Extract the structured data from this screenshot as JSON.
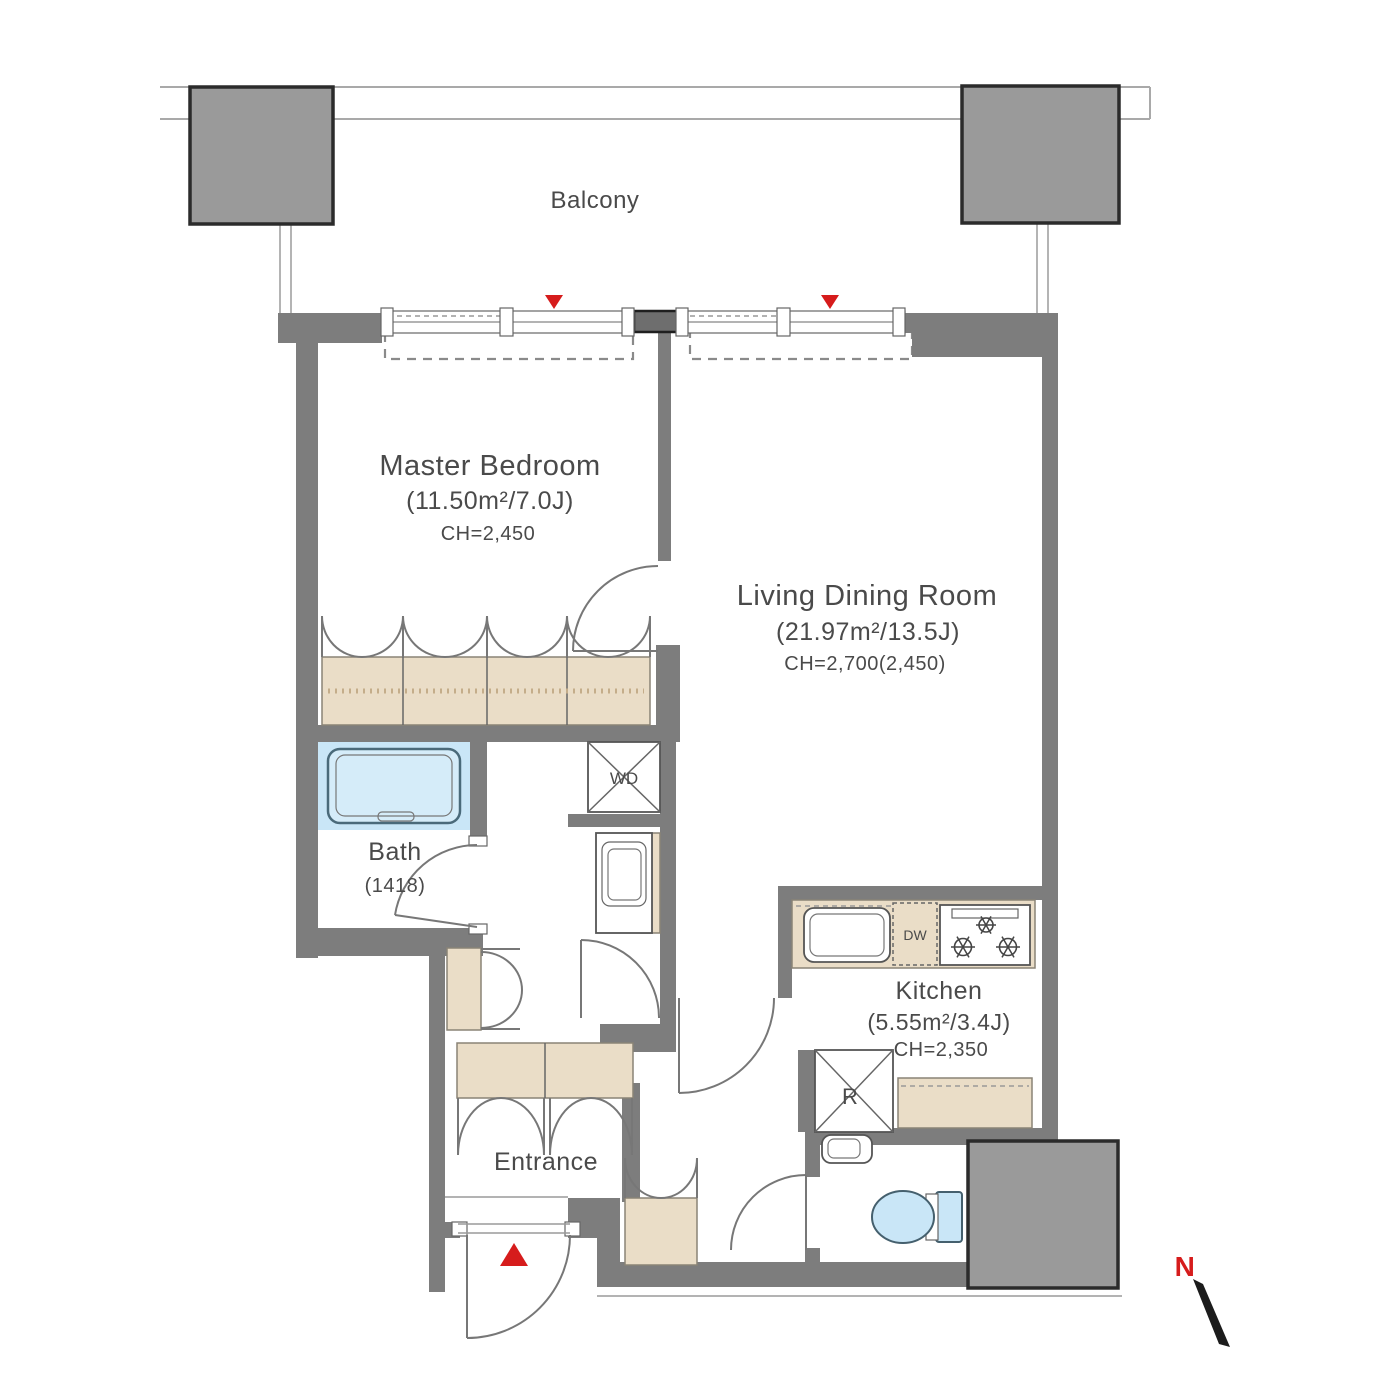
{
  "balcony": {
    "label": "Balcony"
  },
  "rooms": {
    "master_bedroom": {
      "name": "Master Bedroom",
      "area": "(11.50m²/7.0J)",
      "ceiling_height": "CH=2,450"
    },
    "living_dining": {
      "name": "Living Dining Room",
      "area": "(21.97m²/13.5J)",
      "ceiling_height": "CH=2,700(2,450)"
    },
    "kitchen": {
      "name": "Kitchen",
      "area": "(5.55m²/3.4J)",
      "ceiling_height": "CH=2,350"
    },
    "bath": {
      "name": "Bath",
      "size": "(1418)"
    },
    "entrance": {
      "name": "Entrance"
    }
  },
  "fixtures": {
    "washer_dryer_label": "WD",
    "dishwasher_label": "DW",
    "refrigerator_label": "R"
  },
  "compass": {
    "north_label": "N"
  },
  "colors": {
    "wall": "#7d7d7d",
    "column": "#9a9a9a",
    "accent_red": "#d61c1c",
    "cabinet_beige": "#eaddc7",
    "water_blue": "#c9e6f7",
    "text": "#4a4a4a"
  }
}
